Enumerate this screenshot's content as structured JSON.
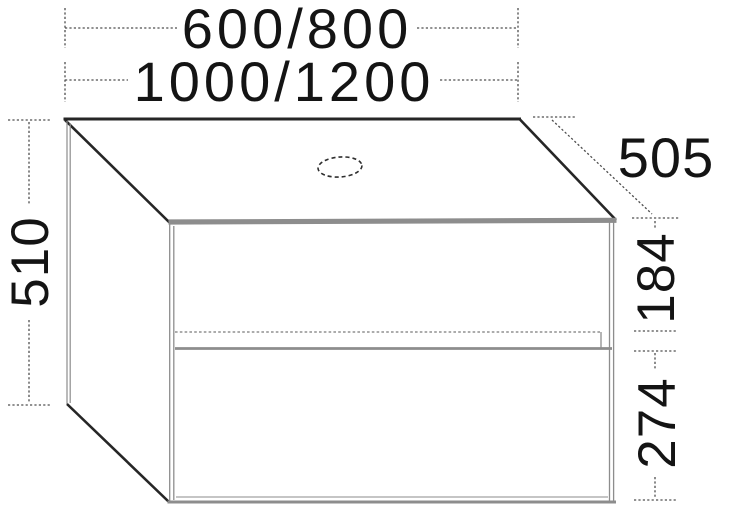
{
  "window": {
    "width_px": 734,
    "height_px": 508,
    "background": "#ffffff"
  },
  "diagram": {
    "kind": "furniture-dimension-drawing",
    "subject": "wall-hung two-drawer vanity cabinet in perspective with cutout for basin drain",
    "labels": {
      "width_options_row1": "600/800",
      "width_options_row2": "1000/1200",
      "depth": "505",
      "height": "510",
      "upper_drawer_height": "184",
      "lower_drawer_height": "274"
    },
    "shapes": {
      "drain_hole": "dashed-ellipse"
    },
    "colors": {
      "edge_dark": "#262626",
      "edge_gray": "#8d8d8d",
      "edge_light": "#b2b2b2",
      "dimension_line": "#4f4f4f",
      "text": "#141414",
      "background": "#ffffff"
    }
  }
}
